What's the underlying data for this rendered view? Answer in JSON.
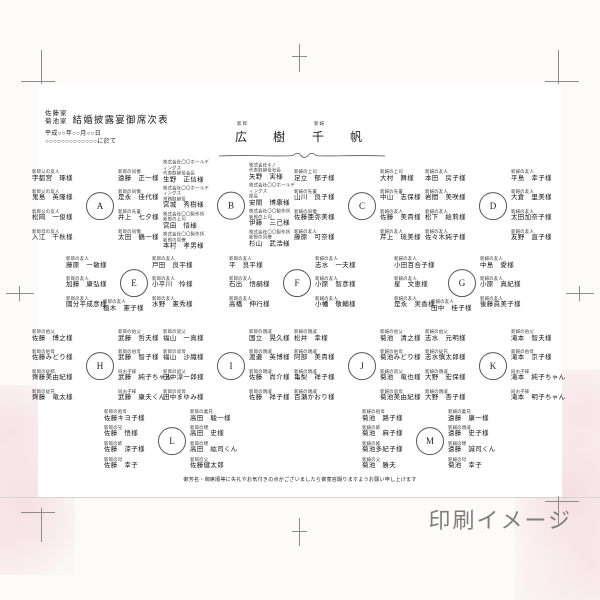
{
  "colors": {
    "watermark_gray": "#7E7E7E",
    "floral_pink": "#ECBAC4",
    "ink": "#1A1A1A"
  },
  "watermark": "印刷イメージ",
  "page": {
    "header": {
      "family_names": [
        "佐藤家",
        "菊池家"
      ],
      "title": "結婚披露宴御席次表",
      "date": "平成○○年○○月○○日",
      "venue": "○○○○○○○○○○○○○に於て"
    },
    "couple": {
      "groom_label": "新郎",
      "groom_name": "広　樹",
      "bride_label": "新婦",
      "bride_name": "千　帆"
    },
    "footnote": "御芳名・御席順等に失礼やお気付きの点がございましたら御寛容賜りますようお願い申し上げます",
    "tables": [
      {
        "id": "A",
        "left": [
          {
            "title": "新郎父の友人",
            "name": "宇都宮　琢様"
          },
          {
            "title": "新郎父の友人",
            "name": "鬼島　英隆様"
          },
          {
            "title": "新郎父の友人",
            "name": "松岡　一俊様"
          },
          {
            "title": "新郎母の友人",
            "name": "入江　千秋様"
          }
        ],
        "right": [
          {
            "title": "新郎の同僚",
            "name": "遠藤　正一様"
          },
          {
            "title": "新郎の同僚",
            "name": "是永　佳代様"
          },
          {
            "title": "新郎の先輩",
            "name": "井上　七夕様"
          },
          {
            "title": "新郎の同僚",
            "name": "太田　鶴一様"
          }
        ]
      },
      {
        "id": "B",
        "left": [
          {
            "title": "株式会社〇〇ホールディングス",
            "title2": "代表取締役会長",
            "name": "生野　正信様"
          },
          {
            "title": "株式会社〇〇ホールディングス",
            "title2": "常務取締役",
            "name": "宮城　秀樹様"
          },
          {
            "title": "株式会社〇〇製作所",
            "title2": "新郎の上司",
            "name": "宮田　悟様"
          },
          {
            "title": "株式会社〇〇製作所",
            "title2": "新郎の同僚",
            "name": "本村　孝男様"
          }
        ],
        "right": [
          {
            "title": "株式会社キノ",
            "title2": "代表取締役社長",
            "name": "矢野　実様"
          },
          {
            "title": "株式会社〇〇ホールディングス",
            "title2": "部長",
            "name": "安間　博康様"
          },
          {
            "title": "株式会社〇〇製作所",
            "title2": "新郎の上司",
            "name": "伊藤　三己様"
          },
          {
            "title": "株式会社〇〇製作所",
            "title2": "新郎の同僚",
            "name": "杉山　武浩様"
          }
        ]
      },
      {
        "id": "C",
        "left": [
          {
            "title": "新婦の上司",
            "name": "足立　郁子様"
          },
          {
            "title": "新婦の先輩",
            "name": "山川　良子様"
          },
          {
            "title": "新婦の同僚",
            "name": "佐藤亜弥美様"
          },
          {
            "title": "新婦の友人",
            "name": "藤原　可奈様"
          }
        ],
        "right": [
          {
            "title": "新婦の上司",
            "name": "大村　舞様"
          },
          {
            "title": "新婦の先輩",
            "name": "中山　志保様"
          },
          {
            "title": "新婦の友人",
            "name": "佐藤　美貴様"
          },
          {
            "title": "新婦の友人",
            "name": "芹上　琉美様"
          }
        ]
      },
      {
        "id": "D",
        "left": [
          {
            "title": "新婦の友人",
            "name": "本田　房子様"
          },
          {
            "title": "新婦の友人",
            "name": "岩間　美咲様"
          },
          {
            "title": "新婦の友人",
            "name": "松下　絵莉様"
          },
          {
            "title": "新婦の友人",
            "name": "佐々木純子様"
          }
        ],
        "right": [
          {
            "title": "新婦の友人",
            "name": "平島　幸子様"
          },
          {
            "title": "新婦の友人",
            "name": "大倉　里美様"
          },
          {
            "title": "新婦の友人",
            "name": "太田加奈子様"
          },
          {
            "title": "新婦の友人",
            "name": "友野　直子様"
          }
        ]
      },
      {
        "id": "E",
        "left": [
          {
            "title": "新郎の友人",
            "name": "藤原　一敏様"
          },
          {
            "title": "新郎の友人",
            "name": "加藤　康弘様"
          },
          {
            "title": "新郎の友人",
            "name": "國分平成彦様"
          }
        ],
        "right": [
          {
            "title": "新郎の友人",
            "name": "戸田　良平様"
          },
          {
            "title": "新郎の友人",
            "name": "小平川　怜様"
          },
          {
            "title": "新郎の友人",
            "name": "水野　憲秀様"
          }
        ],
        "bottom": {
          "title": "新郎の友人",
          "name": "植木　憲子様"
        }
      },
      {
        "id": "F",
        "left": [
          {
            "title": "新郎の友人",
            "name": "平　良平様"
          },
          {
            "title": "新郎の友人",
            "name": "石出　悟嗣様"
          },
          {
            "title": "新郎の友人",
            "name": "高橋　伸行様"
          }
        ],
        "right": [
          {
            "title": "新婦の友人",
            "name": "志水　一夫様"
          },
          {
            "title": "新婦の友人",
            "name": "小原　智彦様"
          },
          {
            "title": "新婦の友人",
            "name": "小幡　敬輔様"
          }
        ]
      },
      {
        "id": "G",
        "left": [
          {
            "title": "新婦の友人",
            "name": "小田百合子様"
          },
          {
            "title": "新婦の友人",
            "name": "星　文恵様"
          },
          {
            "title": "新婦の友人",
            "name": "是永　実香様"
          }
        ],
        "right": [
          {
            "title": "新婦の友人",
            "name": "中島　愛様"
          },
          {
            "title": "新婦の友人",
            "name": "小原　真紀様"
          },
          {
            "title": "新婦の友人",
            "name": "後藤眞美子様"
          }
        ],
        "bottom": {
          "title": "新婦の友人",
          "name": "田中　桂子様"
        }
      },
      {
        "id": "H",
        "left": [
          {
            "title": "新郎の伯父",
            "name": "佐藤　博之様"
          },
          {
            "title": "新郎の伯母",
            "name": "佐藤みどり様"
          },
          {
            "title": "新郎の従姉",
            "name": "齊藤美由紀様"
          },
          {
            "title": "新郎の従兄",
            "name": "齊藤　竜太様"
          }
        ],
        "right": [
          {
            "title": "新郎の伯父",
            "name": "武藤　哲夫様"
          },
          {
            "title": "新郎の伯母",
            "name": "武藤　智子様"
          },
          {
            "title": "同お子様",
            "name": "武藤　純子ちゃん"
          },
          {
            "title": "同お子様",
            "name": "武藤　康夫くん"
          }
        ]
      },
      {
        "id": "I",
        "left": [
          {
            "title": "新郎の叔父",
            "name": "福山　一真様"
          },
          {
            "title": "新郎の叔母",
            "name": "福山　沙織様"
          },
          {
            "title": "新郎の叔父",
            "name": "田中淳一郎様"
          },
          {
            "title": "新郎の叔母",
            "name": "田中まゆみ様"
          }
        ],
        "right": [
          {
            "title": "新郎の親戚",
            "name": "国立　晃久様"
          },
          {
            "title": "新郎の親戚",
            "name": "渡邉　英博様"
          },
          {
            "title": "新郎の親戚",
            "name": "佐藤　尚介様"
          },
          {
            "title": "新郎の親戚",
            "name": "佐藤　祥子様"
          }
        ]
      },
      {
        "id": "J",
        "left": [
          {
            "title": "新婦の親戚",
            "name": "松井　幸様"
          },
          {
            "title": "新婦の親戚",
            "name": "阿部　美貴様"
          },
          {
            "title": "新婦の親戚",
            "name": "亀梨　祥子様"
          },
          {
            "title": "新婦の親戚",
            "name": "百瀬かおり様"
          }
        ],
        "right": [
          {
            "title": "新婦の伯父",
            "name": "菊池　清之様"
          },
          {
            "title": "新婦の伯母",
            "name": "菊池みどり様"
          },
          {
            "title": "新婦の叔父",
            "name": "菊池　竜也様"
          },
          {
            "title": "新婦の叔母",
            "name": "菊池美由紀様"
          }
        ]
      },
      {
        "id": "K",
        "left": [
          {
            "title": "新婦の伯父",
            "name": "志水　元明様"
          },
          {
            "title": "新婦の従兄",
            "name": "志水慎太郎様"
          },
          {
            "title": "新婦の親戚",
            "name": "大野　宏保様"
          },
          {
            "title": "新婦の親戚",
            "name": "大野　杏子様"
          }
        ],
        "right": [
          {
            "title": "新婦の伯父",
            "name": "滝本　智夫様"
          },
          {
            "title": "新婦の伯母",
            "name": "滝本　京子様"
          },
          {
            "title": "同お子様",
            "name": "滝本　純子ちゃん"
          },
          {
            "title": "同お子様",
            "name": "滝本　明子ちゃん"
          }
        ]
      },
      {
        "id": "L",
        "left": [
          {
            "title": "新郎の祖母",
            "name": "佐藤キヨ子様"
          },
          {
            "title": "新郎の兄",
            "name": "佐藤　悟様"
          },
          {
            "title": "新郎の姉",
            "name": "佐藤　涼子様"
          },
          {
            "title": "新郎の母",
            "name": "佐藤　幸子"
          }
        ],
        "right": [
          {
            "title": "新郎の義兄",
            "name": "高田　駿一様"
          },
          {
            "title": "新郎の甥",
            "name": "高田　史様"
          },
          {
            "title": "新郎の甥",
            "name": "高田　紘司くん"
          },
          {
            "title": "新郎の父",
            "name": "佐藤健太郎"
          }
        ]
      },
      {
        "id": "M",
        "left": [
          {
            "title": "新婦の祖母",
            "name": "菊池　路子様"
          },
          {
            "title": "新婦の姉",
            "name": "菊池　麻子様"
          },
          {
            "title": "新婦の姉",
            "name": "菊池多紀子様"
          },
          {
            "title": "新婦の父",
            "name": "菊池　勝夫"
          }
        ],
        "right": [
          {
            "title": "新婦の義兄",
            "name": "遠藤　康一様"
          },
          {
            "title": "新婦の親戚",
            "name": "遠藤　史子様"
          },
          {
            "title": "新婦の甥",
            "name": "遠藤　誠司くん"
          },
          {
            "title": "新婦の母",
            "name": "菊池　幸子"
          }
        ]
      }
    ]
  }
}
